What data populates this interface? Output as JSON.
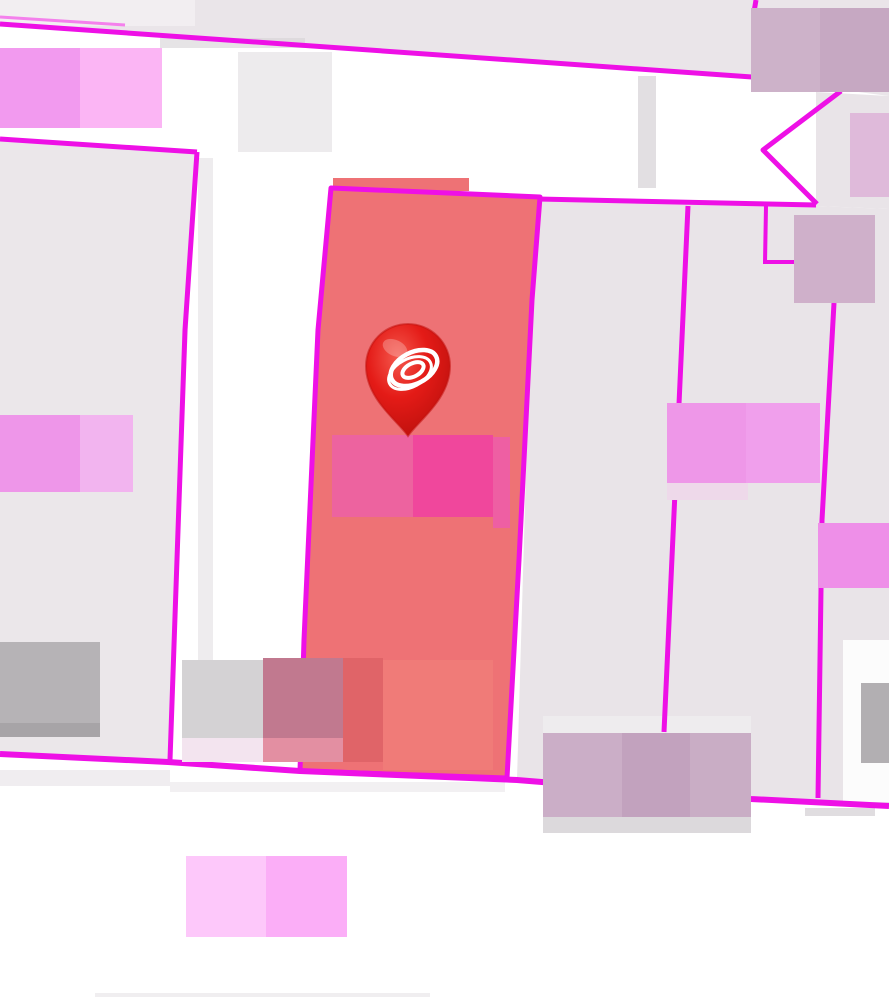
{
  "map": {
    "width": 889,
    "height": 1006,
    "background": "#ffffff",
    "colors": {
      "boundary_magenta": "#ee10e6",
      "boundary_magenta_light": "#f480ec",
      "parcel_lavender": "#e9e4e8",
      "parcel_lavender_west": "#ebe7ea",
      "parcel_lavender_north": "#eae5e9",
      "selected_parcel_fill": "#ee7275",
      "pin_red": "#e41b17"
    },
    "layers": [
      {
        "type": "polygon",
        "name": "parcel-block-north",
        "points": [
          [
            0,
            0
          ],
          [
            889,
            0
          ],
          [
            889,
            96
          ],
          [
            752,
            78
          ],
          [
            0,
            25
          ]
        ],
        "fill": "#eae5e9",
        "interactable": true
      },
      {
        "type": "polygon",
        "name": "parcel-west",
        "points": [
          [
            0,
            139
          ],
          [
            196,
            152
          ],
          [
            168,
            763
          ],
          [
            0,
            754
          ]
        ],
        "fill": "#ebe7ea",
        "interactable": true
      },
      {
        "type": "polygon",
        "name": "parcel-block-east",
        "points": [
          [
            540,
            200
          ],
          [
            816,
            206
          ],
          [
            889,
            209
          ],
          [
            889,
            803
          ],
          [
            752,
            799
          ],
          [
            517,
            779
          ],
          [
            531,
            300
          ]
        ],
        "fill": "#e9e4e8",
        "interactable": true
      },
      {
        "type": "polygon",
        "name": "parcel-wedge-northeast",
        "points": [
          [
            816,
            92
          ],
          [
            889,
            96
          ],
          [
            889,
            209
          ],
          [
            816,
            206
          ]
        ],
        "fill": "#e9e4e8",
        "interactable": true
      },
      {
        "type": "rect",
        "name": "road-shading-top-left",
        "x": 0,
        "y": 0,
        "w": 195,
        "h": 26,
        "fill": "#f6f4f6",
        "opacity": 0.6
      },
      {
        "type": "rect",
        "name": "road-shading-under-top-line",
        "x": 160,
        "y": 38,
        "w": 145,
        "h": 10,
        "fill": "#d5d2d5",
        "opacity": 0.6
      },
      {
        "type": "rect",
        "name": "road-shading-mid-top",
        "x": 238,
        "y": 52,
        "w": 94,
        "h": 100,
        "fill": "#ebe9eb",
        "opacity": 0.9
      },
      {
        "type": "rect",
        "name": "road-shading-vertical-strip",
        "x": 638,
        "y": 76,
        "w": 18,
        "h": 112,
        "fill": "#dfdcdf",
        "opacity": 0.9
      },
      {
        "type": "rect",
        "name": "road-shading-west-edge",
        "x": 198,
        "y": 158,
        "w": 15,
        "h": 540,
        "fill": "#eae7ea",
        "opacity": 0.8
      },
      {
        "type": "rect",
        "name": "road-shading-bottom-left",
        "x": 0,
        "y": 770,
        "w": 170,
        "h": 16,
        "fill": "#e9e6e9",
        "opacity": 0.7
      },
      {
        "type": "rect",
        "name": "road-shading-bottom-mid",
        "x": 170,
        "y": 782,
        "w": 335,
        "h": 10,
        "fill": "#eceaec",
        "opacity": 0.7
      },
      {
        "type": "rect",
        "name": "road-shading-below-line-right",
        "x": 805,
        "y": 808,
        "w": 70,
        "h": 8,
        "fill": "#d8d5d8",
        "opacity": 0.8
      },
      {
        "type": "rect",
        "name": "road-white-pocket-southeast",
        "x": 843,
        "y": 640,
        "w": 46,
        "h": 162,
        "fill": "#fdfdfd",
        "opacity": 0.95
      },
      {
        "type": "rect",
        "name": "road-dither-above-building",
        "x": 543,
        "y": 716,
        "w": 208,
        "h": 17,
        "fill": "#efedef",
        "opacity": 0.8
      },
      {
        "type": "rect",
        "name": "road-shading-bottom-strip",
        "x": 95,
        "y": 993,
        "w": 335,
        "h": 4,
        "fill": "#eceaec",
        "opacity": 0.8
      },
      {
        "type": "rect",
        "name": "selected-parcel-fill-notch",
        "x": 333,
        "y": 178,
        "w": 136,
        "h": 13,
        "fill": "#ee7275"
      },
      {
        "type": "polygon",
        "name": "selected-parcel",
        "points": [
          [
            331,
            188
          ],
          [
            540,
            197
          ],
          [
            532,
            300
          ],
          [
            519,
            560
          ],
          [
            507,
            778
          ],
          [
            300,
            771
          ],
          [
            304,
            640
          ],
          [
            318,
            330
          ]
        ],
        "fill": "#ee7275",
        "stroke": "#ee10e6",
        "width": 5,
        "interactable": true
      },
      {
        "type": "polyline",
        "name": "parcel-boundary-top-echo",
        "points": [
          [
            0,
            17
          ],
          [
            125,
            25
          ]
        ],
        "stroke": "#f480ec",
        "width": 3
      },
      {
        "type": "polyline",
        "name": "parcel-boundary-top",
        "points": [
          [
            0,
            24
          ],
          [
            752,
            77
          ]
        ],
        "stroke": "#ee10e6",
        "width": 5
      },
      {
        "type": "polyline",
        "name": "parcel-boundary-stub-top",
        "points": [
          [
            756,
            0
          ],
          [
            754,
            12
          ]
        ],
        "stroke": "#ee10e6",
        "width": 5
      },
      {
        "type": "polyline",
        "name": "parcel-boundary-west-top",
        "points": [
          [
            0,
            139
          ],
          [
            197,
            152
          ]
        ],
        "stroke": "#ee10e6",
        "width": 5
      },
      {
        "type": "polyline",
        "name": "parcel-boundary-west-east-edge",
        "points": [
          [
            197,
            152
          ],
          [
            185,
            330
          ],
          [
            170,
            760
          ]
        ],
        "stroke": "#ee10e6",
        "width": 5
      },
      {
        "type": "polyline",
        "name": "parcel-boundary-south",
        "points": [
          [
            0,
            754
          ],
          [
            168,
            762
          ],
          [
            300,
            771
          ],
          [
            517,
            780
          ],
          [
            751,
            799
          ],
          [
            889,
            806
          ]
        ],
        "stroke": "#ee10e6",
        "width": 6
      },
      {
        "type": "polyline",
        "name": "parcel-boundary-east-horizontal",
        "points": [
          [
            538,
            199
          ],
          [
            816,
            205
          ]
        ],
        "stroke": "#ee10e6",
        "width": 5
      },
      {
        "type": "polyline",
        "name": "parcel-boundary-chevron",
        "points": [
          [
            841,
            91
          ],
          [
            763,
            150
          ],
          [
            817,
            204
          ]
        ],
        "stroke": "#ee10e6",
        "width": 5
      },
      {
        "type": "polyline",
        "name": "parcel-boundary-notch-vertical",
        "points": [
          [
            766,
            206
          ],
          [
            765,
            263
          ]
        ],
        "stroke": "#ee10e6",
        "width": 4
      },
      {
        "type": "polyline",
        "name": "parcel-boundary-notch-horizontal",
        "points": [
          [
            763,
            262
          ],
          [
            796,
            262
          ]
        ],
        "stroke": "#ee10e6",
        "width": 4
      },
      {
        "type": "polyline",
        "name": "parcel-boundary-east-vertical-1",
        "points": [
          [
            688,
            206
          ],
          [
            676,
            470
          ],
          [
            664,
            732
          ]
        ],
        "stroke": "#ee10e6",
        "width": 5
      },
      {
        "type": "polyline",
        "name": "parcel-boundary-east-vertical-2",
        "points": [
          [
            834,
            303
          ],
          [
            822,
            520
          ],
          [
            818,
            798
          ]
        ],
        "stroke": "#ee10e6",
        "width": 5
      },
      {
        "type": "rect",
        "name": "building-gray-center",
        "x": 182,
        "y": 660,
        "w": 81,
        "h": 78,
        "fill": "#d4d2d4"
      },
      {
        "type": "rect",
        "name": "building-gray-center-base",
        "x": 182,
        "y": 738,
        "w": 81,
        "h": 24,
        "fill": "#f3e4ef"
      },
      {
        "type": "rect",
        "name": "building-rose-center",
        "x": 263,
        "y": 658,
        "w": 80,
        "h": 80,
        "fill": "#c1798f"
      },
      {
        "type": "rect",
        "name": "building-rose-center-base",
        "x": 263,
        "y": 738,
        "w": 80,
        "h": 24,
        "fill": "#e38fa2"
      },
      {
        "type": "rect",
        "name": "building-dark-salmon",
        "x": 343,
        "y": 658,
        "w": 40,
        "h": 104,
        "fill": "#e06468"
      },
      {
        "type": "rect",
        "name": "building-salmon-overlay",
        "x": 383,
        "y": 660,
        "w": 110,
        "h": 110,
        "fill": "#f07b78"
      },
      {
        "type": "rect",
        "name": "building-gray-west",
        "x": 0,
        "y": 642,
        "w": 100,
        "h": 81,
        "fill": "#b6b3b6"
      },
      {
        "type": "rect",
        "name": "building-gray-west-base",
        "x": 0,
        "y": 723,
        "w": 100,
        "h": 14,
        "fill": "#a7a4a7"
      },
      {
        "type": "rect",
        "name": "building-pink-northwest-a",
        "x": 0,
        "y": 48,
        "w": 80,
        "h": 80,
        "fill": "#f29aef"
      },
      {
        "type": "rect",
        "name": "building-pink-northwest-b",
        "x": 80,
        "y": 48,
        "w": 82,
        "h": 80,
        "fill": "#fbb5f4"
      },
      {
        "type": "rect",
        "name": "building-pink-west-a",
        "x": 0,
        "y": 415,
        "w": 80,
        "h": 77,
        "fill": "#ee96e9"
      },
      {
        "type": "rect",
        "name": "building-pink-west-b",
        "x": 80,
        "y": 415,
        "w": 53,
        "h": 77,
        "fill": "#f2b4ef"
      },
      {
        "type": "rect",
        "name": "building-hotpink-selected-a",
        "x": 332,
        "y": 435,
        "w": 81,
        "h": 82,
        "fill": "#ed639f"
      },
      {
        "type": "rect",
        "name": "building-hotpink-selected-b",
        "x": 413,
        "y": 435,
        "w": 80,
        "h": 82,
        "fill": "#f0479c"
      },
      {
        "type": "rect",
        "name": "building-hotpink-selected-edge",
        "x": 493,
        "y": 437,
        "w": 17,
        "h": 91,
        "fill": "#ee5fa3"
      },
      {
        "type": "rect",
        "name": "building-mauve-northeast-a",
        "x": 751,
        "y": 8,
        "w": 69,
        "h": 84,
        "fill": "#cdb2c9"
      },
      {
        "type": "rect",
        "name": "building-mauve-northeast-b",
        "x": 820,
        "y": 8,
        "w": 69,
        "h": 84,
        "fill": "#c6a8c2"
      },
      {
        "type": "rect",
        "name": "building-lilac-east-edge",
        "x": 850,
        "y": 113,
        "w": 39,
        "h": 84,
        "fill": "#dfbada"
      },
      {
        "type": "rect",
        "name": "building-mauve-east-upper",
        "x": 794,
        "y": 215,
        "w": 81,
        "h": 88,
        "fill": "#cfb0ca"
      },
      {
        "type": "rect",
        "name": "building-pink-east-a",
        "x": 667,
        "y": 403,
        "w": 79,
        "h": 80,
        "fill": "#ee97e8"
      },
      {
        "type": "rect",
        "name": "building-pink-east-b",
        "x": 746,
        "y": 403,
        "w": 74,
        "h": 80,
        "fill": "#f09fec"
      },
      {
        "type": "rect",
        "name": "building-pink-east-base",
        "x": 667,
        "y": 483,
        "w": 81,
        "h": 17,
        "fill": "#eed9ea"
      },
      {
        "type": "rect",
        "name": "building-pink-east-lower",
        "x": 818,
        "y": 523,
        "w": 71,
        "h": 65,
        "fill": "#ee8fe8"
      },
      {
        "type": "rect",
        "name": "building-mauve-south-a",
        "x": 543,
        "y": 733,
        "w": 79,
        "h": 84,
        "fill": "#cbaec7"
      },
      {
        "type": "rect",
        "name": "building-mauve-south-b",
        "x": 622,
        "y": 733,
        "w": 68,
        "h": 84,
        "fill": "#c2a2be"
      },
      {
        "type": "rect",
        "name": "building-mauve-south-c",
        "x": 690,
        "y": 733,
        "w": 61,
        "h": 84,
        "fill": "#c9adc5"
      },
      {
        "type": "rect",
        "name": "building-mauve-south-base",
        "x": 543,
        "y": 817,
        "w": 208,
        "h": 16,
        "fill": "#dcd9dc"
      },
      {
        "type": "rect",
        "name": "building-gray-southeast",
        "x": 861,
        "y": 683,
        "w": 28,
        "h": 80,
        "fill": "#b2afb2"
      },
      {
        "type": "rect",
        "name": "building-pink-south-a",
        "x": 186,
        "y": 856,
        "w": 80,
        "h": 81,
        "fill": "#fdc8fa"
      },
      {
        "type": "rect",
        "name": "building-pink-south-b",
        "x": 266,
        "y": 856,
        "w": 81,
        "h": 81,
        "fill": "#fbaef7"
      }
    ],
    "marker": {
      "name": "location-pin",
      "icon": "stadium-ring-icon",
      "tip_x": 408,
      "tip_y": 436,
      "radius": 42,
      "center_offset_y": -70,
      "body_color": "#e41b17",
      "body_dark": "#b90f0c",
      "body_light": "#f4584d",
      "rim_color": "#c3120e",
      "icon_color": "#ffffff",
      "interactable": true
    }
  }
}
